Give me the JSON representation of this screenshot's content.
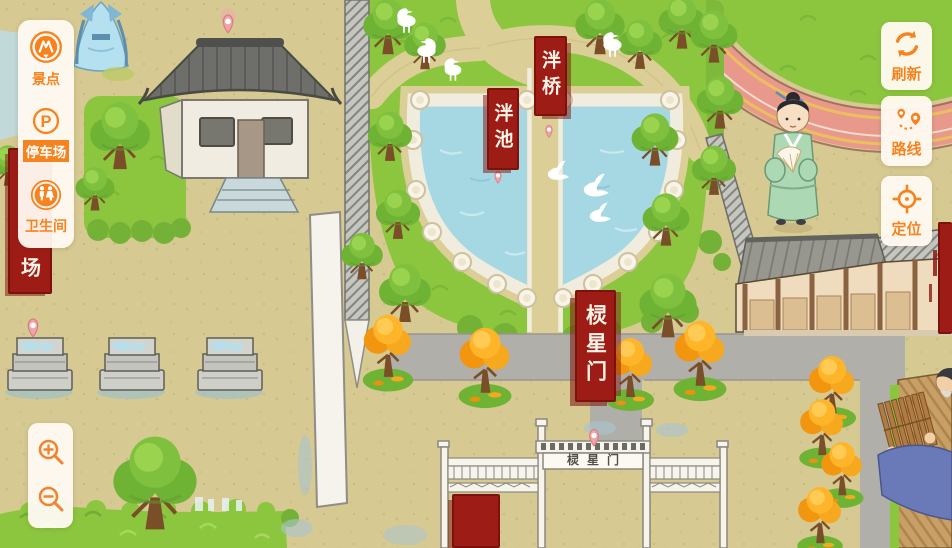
{
  "ui": {
    "sidebar": {
      "items": [
        {
          "id": "scenic",
          "label": "景点",
          "icon": "scenic-spot-icon",
          "highlighted": false
        },
        {
          "id": "parking",
          "label": "停车场",
          "icon": "parking-icon",
          "icon_letter": "P",
          "highlighted": true
        },
        {
          "id": "restroom",
          "label": "卫生间",
          "icon": "restroom-icon",
          "highlighted": false
        }
      ]
    },
    "map_buttons": [
      {
        "id": "refresh",
        "label": "刷新",
        "icon": "refresh-icon"
      },
      {
        "id": "route",
        "label": "路线",
        "icon": "route-icon"
      },
      {
        "id": "locate",
        "label": "定位",
        "icon": "locate-icon"
      }
    ],
    "zoom_controls": [
      {
        "id": "zoom-in",
        "icon": "zoom-in-icon"
      },
      {
        "id": "zoom-out",
        "icon": "zoom-out-icon"
      }
    ],
    "accent_color": "#F5831F"
  },
  "map": {
    "poi_banners": [
      {
        "id": "pan-bridge",
        "text": "泮桥"
      },
      {
        "id": "pan-pond",
        "text": "泮池"
      },
      {
        "id": "lingxing-gate",
        "text": "棂星门"
      },
      {
        "id": "square-partial",
        "text": "场"
      },
      {
        "id": "bottom-partial",
        "text": ""
      },
      {
        "id": "right-edge-partial",
        "text": ""
      }
    ],
    "gate_plaque_text": "棂星门",
    "colors": {
      "banner_red": "#9E1C16",
      "water_blue": "#A6D8E4",
      "grass_green": "#8CC63F",
      "ground_tan": "#D6C992",
      "road_gray": "#B1AFA9",
      "track_salmon": "#E8998B"
    }
  }
}
